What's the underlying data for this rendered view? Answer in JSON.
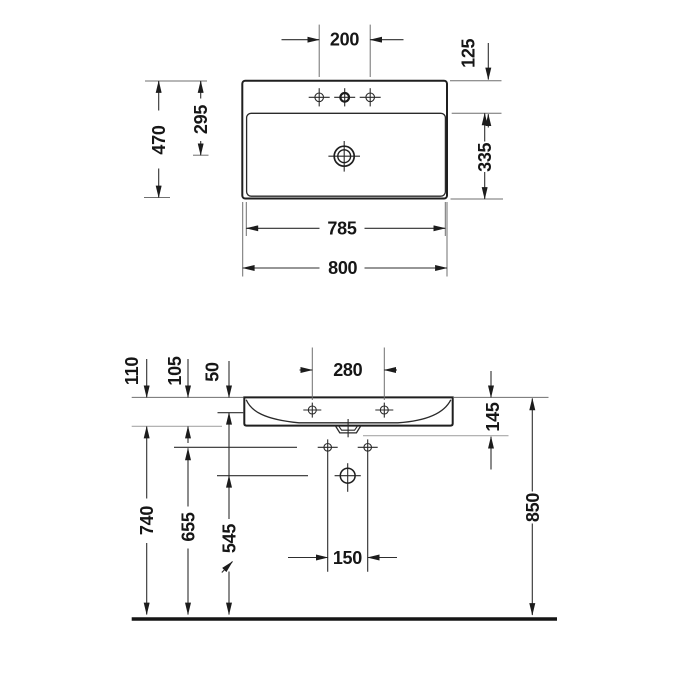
{
  "document": {
    "type": "technical-drawing",
    "subject": "wall-mounted washbasin dimensional drawing, plan view and front elevation, dimensions in mm"
  },
  "plan_view": {
    "dims": {
      "tap_hole_spacing": "200",
      "tap_edge_offset": "125",
      "overall_depth": "470",
      "drain_from_back": "295",
      "bowl_depth": "335",
      "bowl_width": "785",
      "overall_width": "800"
    }
  },
  "front_view": {
    "dims": {
      "front_height": "110",
      "bowl_inner_height": "105",
      "tap_axis_offset": "50",
      "tap_hole_spacing": "280",
      "edge_height": "145",
      "underside_height": "740",
      "fixing_height": "655",
      "drain_height": "545",
      "fixing_hole_spacing": "150",
      "rim_height": "850"
    },
    "icons": {
      "adjustable_arrow": "northeast-arrow"
    }
  },
  "colors": {
    "background": "#ffffff",
    "outline": "#1f1f1f",
    "dimension_line": "#2e2e2e",
    "reference_line": "#a8a8a8"
  }
}
